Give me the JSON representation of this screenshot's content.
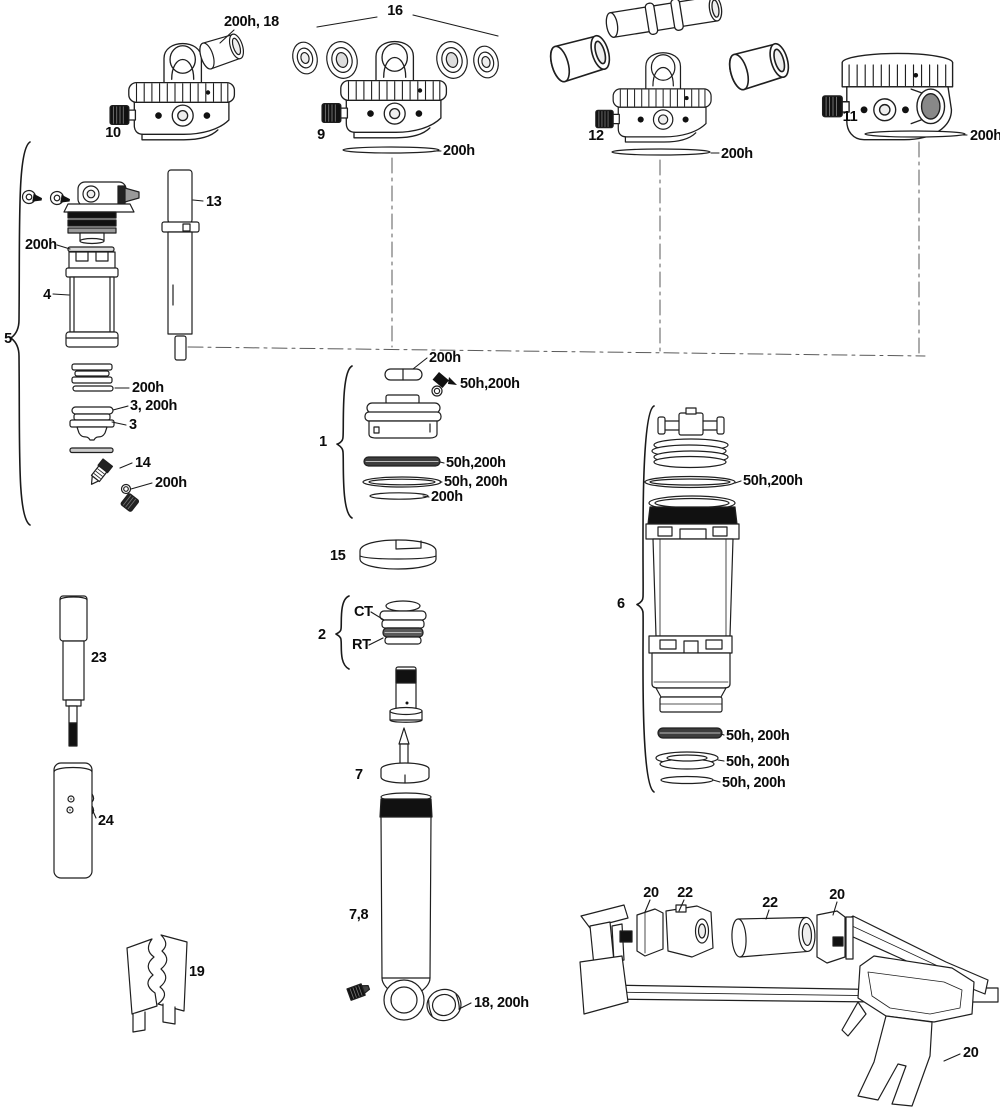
{
  "labels": {
    "bushing18_top": "200h, 18",
    "group16": "16",
    "part10": "10",
    "part9": "9",
    "seal9": "200h",
    "part12": "12",
    "seal12": "200h",
    "part11": "11",
    "seal11": "200h",
    "part13": "13",
    "shim5": "200h",
    "part4": "4",
    "group5": "5",
    "glide5": "200h",
    "ring3": "3, 200h",
    "part3": "3",
    "part14": "14",
    "oring14": "200h",
    "cap1": "200h",
    "pin1": "50h,200h",
    "group1": "1",
    "ring1a": "50h,200h",
    "ring1b": "50h, 200h",
    "ring1c": "200h",
    "part15": "15",
    "group2": "2",
    "ct": "CT",
    "rt": "RT",
    "part7": "7",
    "part78": "7,8",
    "bushing18_bottom": "18, 200h",
    "group6": "6",
    "oring6": "50h,200h",
    "ring6a": "50h, 200h",
    "ring6b": "50h, 200h",
    "ring6c": "50h, 200h",
    "part23": "23",
    "part24": "24",
    "part19": "19",
    "tool20_left": "20",
    "tool22_block": "22",
    "tool22_tube": "22",
    "tool20_right": "20",
    "tool20_handle": "20"
  }
}
